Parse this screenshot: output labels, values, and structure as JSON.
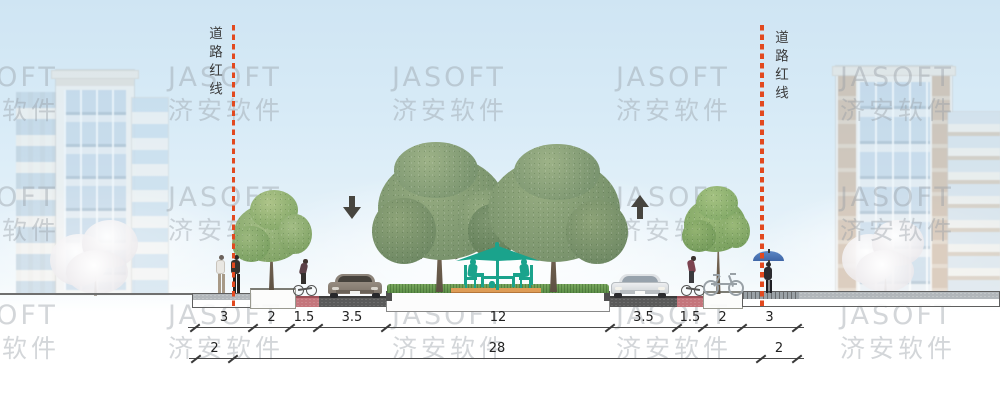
{
  "watermark": {
    "line1": "JASOFT",
    "line2": "济安软件",
    "grid": {
      "cols": [
        -56,
        168,
        392,
        616,
        840
      ],
      "rows": [
        62,
        182,
        300
      ]
    }
  },
  "labels": {
    "road_red_line": "道路红线"
  },
  "arrows": [
    {
      "name": "inbound-lane-direction",
      "glyph": "down"
    },
    {
      "name": "outbound-lane-direction",
      "glyph": "up"
    }
  ],
  "dimensions": {
    "rows": [
      {
        "y": 327,
        "segments": [
          {
            "label": "3",
            "from": 195,
            "to": 253
          },
          {
            "label": "2",
            "from": 253,
            "to": 290
          },
          {
            "label": "1.5",
            "from": 290,
            "to": 318
          },
          {
            "label": "3.5",
            "from": 318,
            "to": 386
          },
          {
            "label": "12",
            "from": 386,
            "to": 610
          },
          {
            "label": "3.5",
            "from": 610,
            "to": 677
          },
          {
            "label": "1.5",
            "from": 677,
            "to": 703
          },
          {
            "label": "2",
            "from": 703,
            "to": 742
          },
          {
            "label": "3",
            "from": 742,
            "to": 797
          }
        ]
      },
      {
        "y": 358,
        "segments": [
          {
            "label": "2",
            "from": 196,
            "to": 233
          },
          {
            "label": "28",
            "from": 233,
            "to": 761
          },
          {
            "label": "2",
            "from": 761,
            "to": 797
          }
        ]
      }
    ]
  },
  "colors": {
    "redline": "#e2491f",
    "bike_lane_pink": "#c4757c",
    "asphalt": "#5a5a5a",
    "median_teal": "#1aa38c",
    "deck_orange": "#de9c56",
    "grass_green": "#6fa058",
    "dimension_ink": "#3a3a3a",
    "watermark_gray": "#9ea6ab"
  },
  "scene_elements": [
    "left-building",
    "right-building",
    "blossom-tree",
    "road-redline",
    "sidewalk",
    "planting-strip-tree",
    "bike-lane",
    "vehicle-lane",
    "central-median-park",
    "patio-umbrella",
    "seated-people",
    "pedestrians",
    "cyclist",
    "parked-bicycle",
    "car",
    "umbrella-pedestrian",
    "traffic-direction-arrow"
  ]
}
